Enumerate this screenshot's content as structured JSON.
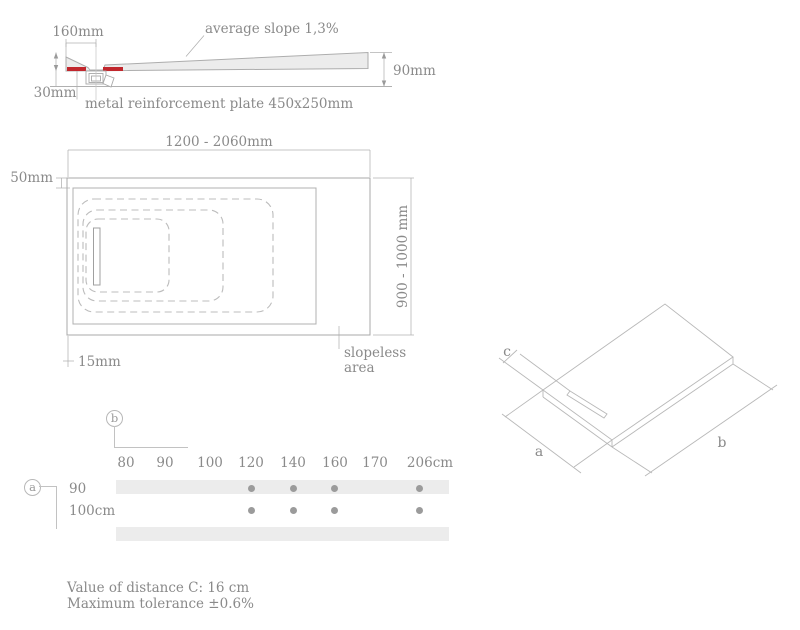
{
  "cross_section": {
    "dim_drain_offset": "160mm",
    "slope_label": "average slope 1,3%",
    "dim_height": "90mm",
    "dim_base": "30mm",
    "plate_label": "metal reinforcement plate 450x250mm"
  },
  "top_view": {
    "width_range": "1200 - 2060mm",
    "edge_top": "50mm",
    "depth_range": "900 - 1000 mm",
    "edge_bottom": "15mm",
    "slopeless_line1": "slopeless",
    "slopeless_line2": "area"
  },
  "size_table": {
    "axis_b": "b",
    "axis_a": "a",
    "columns": [
      "80",
      "90",
      "100",
      "120",
      "140",
      "160",
      "170",
      "206cm"
    ],
    "rows": [
      {
        "label": "90",
        "available": [
          false,
          false,
          false,
          true,
          true,
          true,
          false,
          true
        ]
      },
      {
        "label": "100cm",
        "available": [
          false,
          false,
          false,
          true,
          true,
          true,
          false,
          true
        ]
      }
    ]
  },
  "iso_view": {
    "label_a": "a",
    "label_b": "b",
    "label_c": "c"
  },
  "notes": {
    "line1": "Value of distance C: 16 cm",
    "line2": "Maximum tolerance ±0.6%"
  },
  "colors": {
    "accent_red": "#c1272d",
    "line_gray": "#b0b0b0",
    "text_gray": "#8a8a8a",
    "band_gray": "#ececec",
    "dot_gray": "#9b9b9b",
    "tray_fill": "#ececec"
  }
}
